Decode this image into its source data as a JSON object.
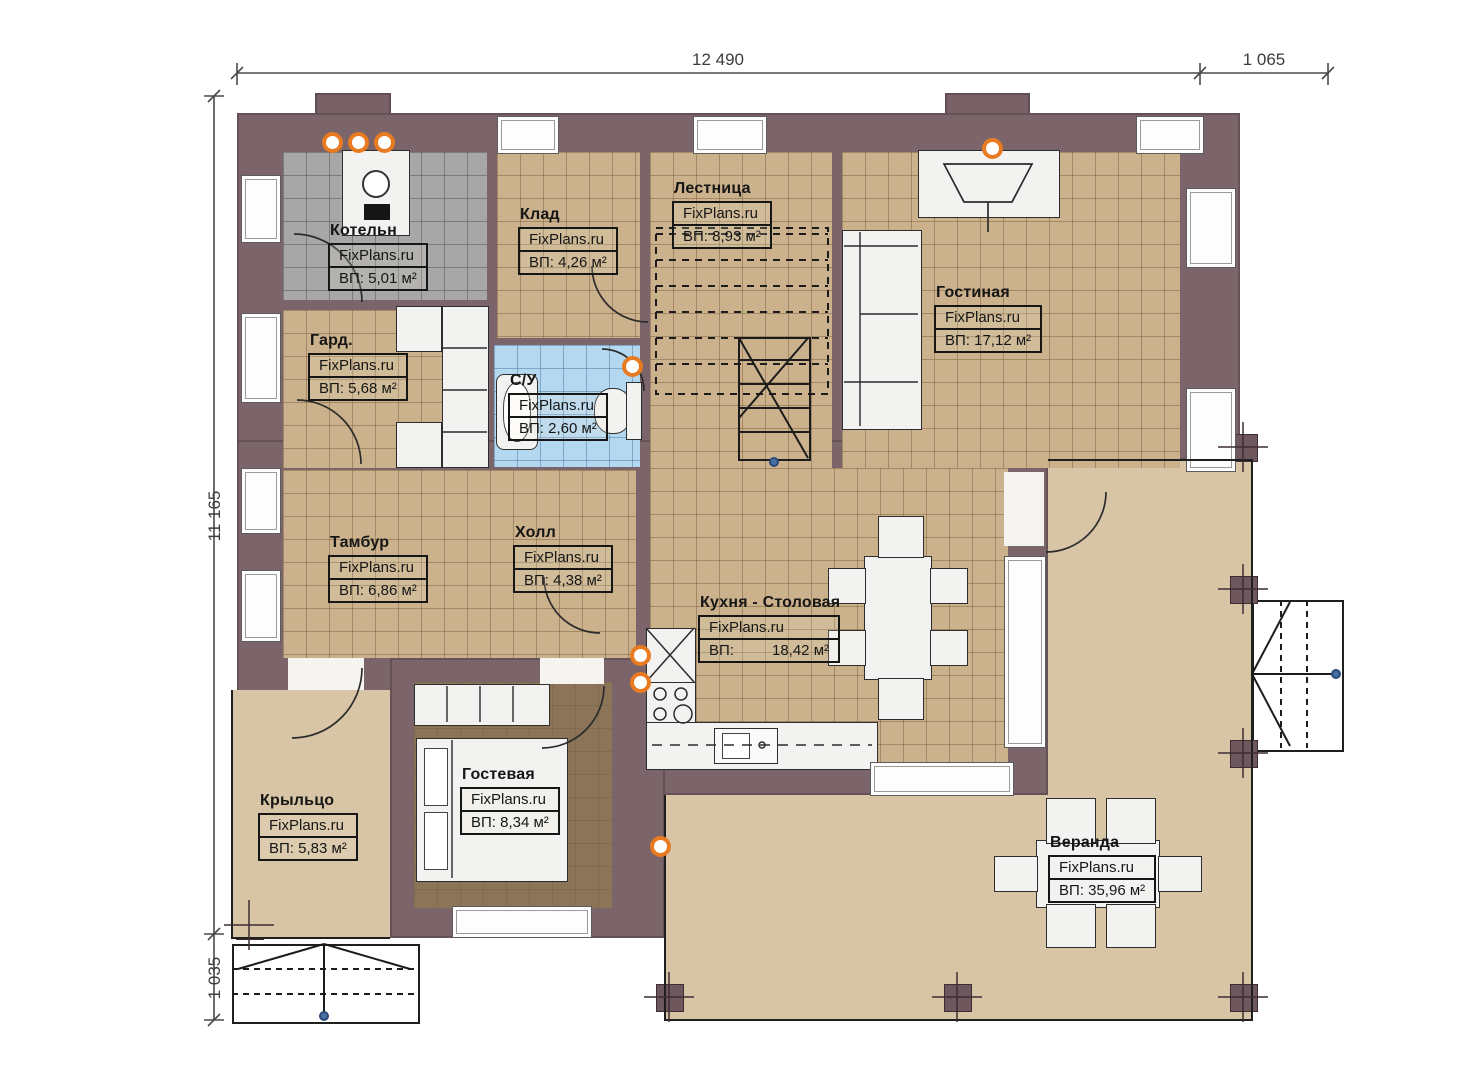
{
  "brand": "FixPlans.ru",
  "dimensions": {
    "top_main": "12 490",
    "top_right": "1 065",
    "left_main": "11 165",
    "left_bottom": "1 035"
  },
  "rooms": [
    {
      "id": "kotelnaya",
      "name": "Котельн",
      "brand": "FixPlans.ru",
      "area": "ВП: 5,01 м²"
    },
    {
      "id": "klad",
      "name": "Клад",
      "brand": "FixPlans.ru",
      "area": "ВП: 4,26 м²"
    },
    {
      "id": "lestnitsa",
      "name": "Лестница",
      "brand": "FixPlans.ru",
      "area": "ВП: 8,93 м²"
    },
    {
      "id": "gostinaya",
      "name": "Гостиная",
      "brand": "FixPlans.ru",
      "area": "ВП: 17,12 м²"
    },
    {
      "id": "garderob",
      "name": "Гард.",
      "brand": "FixPlans.ru",
      "area": "ВП: 5,68 м²"
    },
    {
      "id": "sanuzel",
      "name": "С/У",
      "brand": "FixPlans.ru",
      "area": "ВП: 2,60 м²"
    },
    {
      "id": "tambur",
      "name": "Тамбур",
      "brand": "FixPlans.ru",
      "area": "ВП: 6,86 м²"
    },
    {
      "id": "holl",
      "name": "Холл",
      "brand": "FixPlans.ru",
      "area": "ВП: 4,38 м²"
    },
    {
      "id": "kuhnya",
      "name": "Кухня - Столовая",
      "brand": "FixPlans.ru",
      "area_label": "ВП:",
      "area_value": "18,42 м²"
    },
    {
      "id": "kryltso",
      "name": "Крыльцо",
      "brand": "FixPlans.ru",
      "area": "ВП: 5,83 м²"
    },
    {
      "id": "gostevaya",
      "name": "Гостевая",
      "brand": "FixPlans.ru",
      "area": "ВП: 8,34 м²"
    },
    {
      "id": "veranda",
      "name": "Веранда",
      "brand": "FixPlans.ru",
      "area": "ВП: 35,96 м²"
    }
  ],
  "colors": {
    "wall": "#7b646a",
    "floor_tile": "#cbb28c",
    "boiler_tile": "#a7a7a7",
    "bath_tile": "#b5d8f1",
    "deck": "#d8c5a5",
    "guest_floor": "#8b7457",
    "lamp_accent": "#e87b22",
    "line": "#1f1f1f"
  }
}
